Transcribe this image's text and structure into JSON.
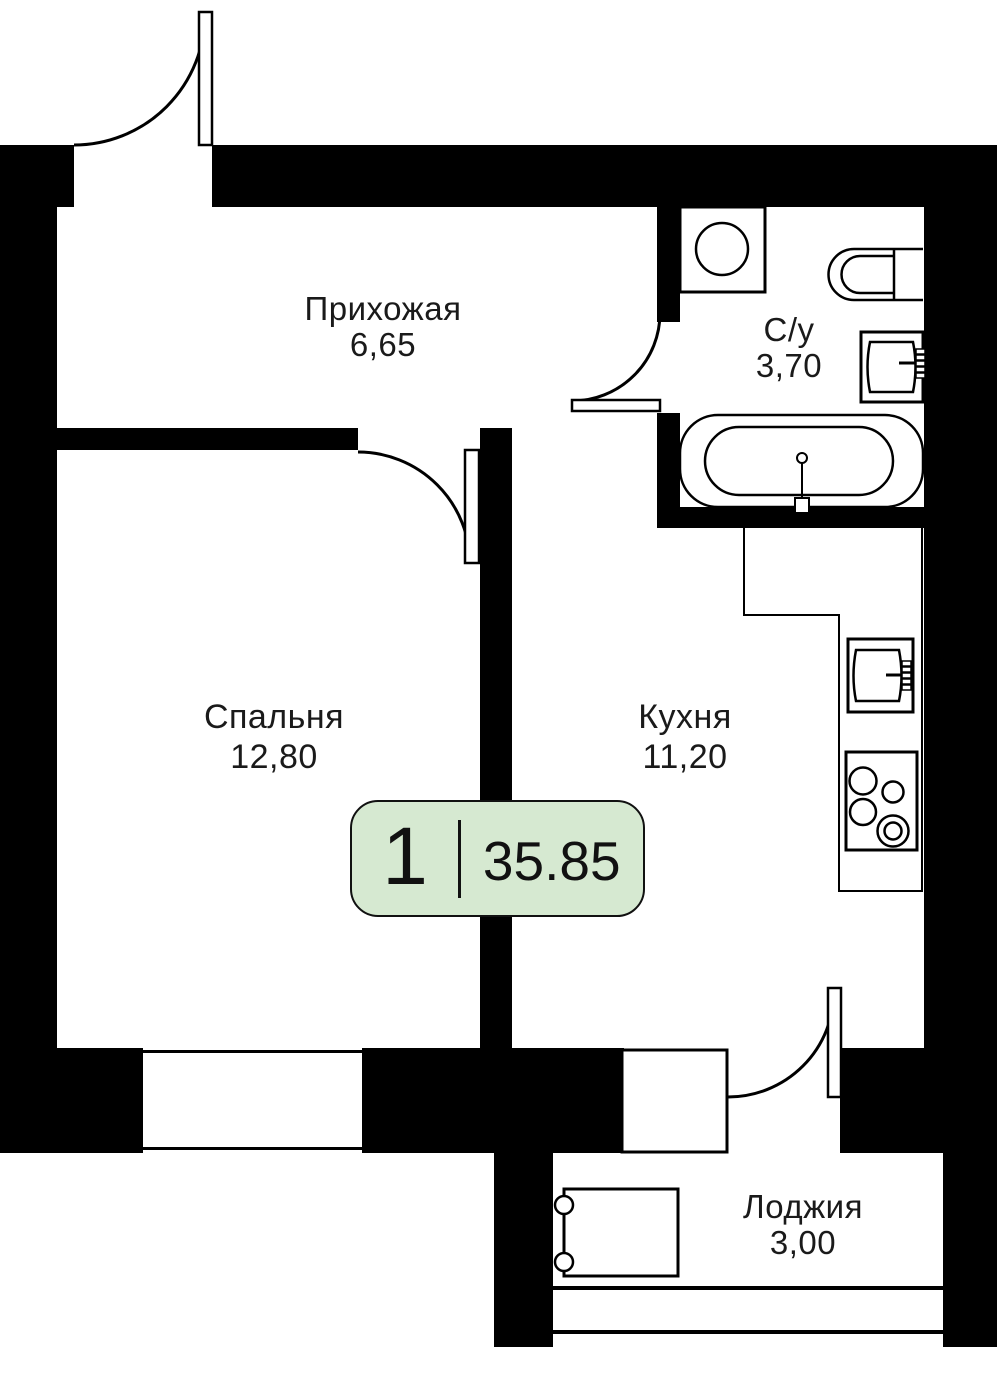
{
  "plan_type": "apartment-floor-plan",
  "badge": {
    "rooms_count": "1",
    "total_area": "35.85",
    "fill_color": "#d6e9d1",
    "border_color": "#111111"
  },
  "rooms": [
    {
      "id": "hallway",
      "name": "Прихожая",
      "area": "6,65"
    },
    {
      "id": "bathroom",
      "name": "С/у",
      "area": "3,70"
    },
    {
      "id": "bedroom",
      "name": "Спальня",
      "area": "12,80"
    },
    {
      "id": "kitchen",
      "name": "Кухня",
      "area": "11,20"
    },
    {
      "id": "loggia",
      "name": "Лоджия",
      "area": "3,00"
    }
  ],
  "fixtures": [
    "washing-machine",
    "toilet",
    "bathroom-sink",
    "bathtub",
    "kitchen-counter",
    "kitchen-sink",
    "stove",
    "loggia-cabinet"
  ],
  "doors": [
    "entry-door",
    "bedroom-door",
    "bathroom-door",
    "loggia-door"
  ],
  "windows": [
    "bedroom-window",
    "kitchen-window",
    "loggia-glazing"
  ],
  "colors": {
    "wall": "#000000",
    "line": "#000000",
    "text": "#1a1a1a",
    "background": "#ffffff"
  }
}
